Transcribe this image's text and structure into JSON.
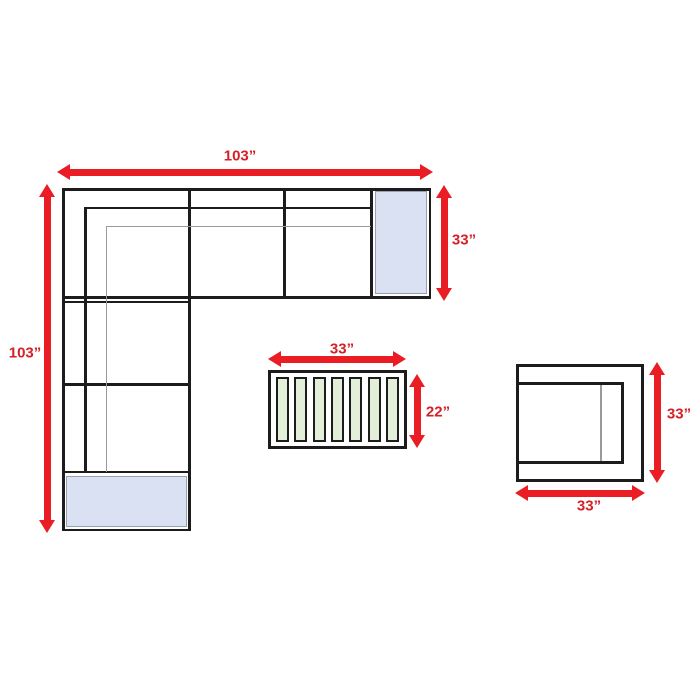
{
  "diagram": {
    "sectional": {
      "width_label": "103”",
      "height_label": "103”",
      "depth_label": "33”"
    },
    "coffee_table": {
      "width_label": "33”",
      "depth_label": "22”",
      "slat_count": 7
    },
    "accent_chair": {
      "height_label": "33”",
      "width_label": "33”"
    }
  },
  "colors": {
    "arrow_red": "#ea1d25",
    "label_red": "#d42127",
    "outline_black": "#1c1c1c",
    "detail_gray": "#9a9a9a",
    "cushion_blue": "#d9e1f2",
    "cushion_border": "#98a1ad",
    "slat_green": "#e4efda",
    "background": "#ffffff"
  }
}
